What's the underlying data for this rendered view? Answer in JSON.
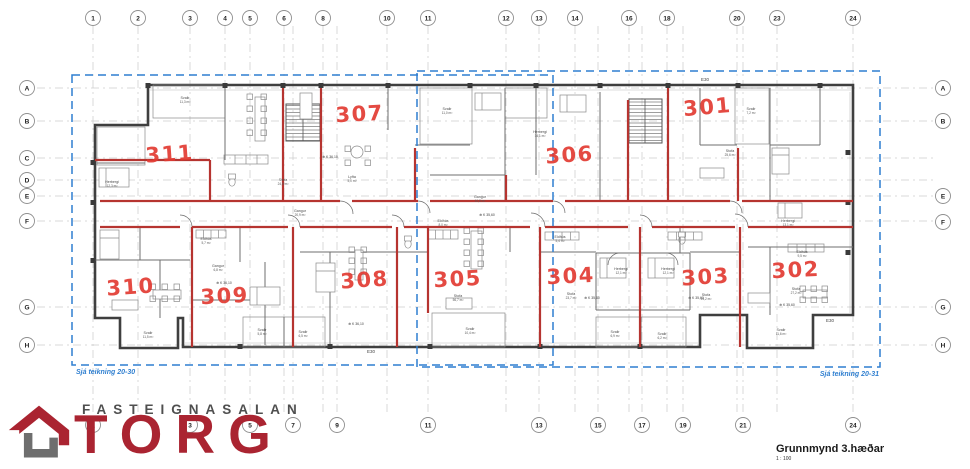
{
  "drawing": {
    "title": "Grunnmynd 3.hæðar",
    "scale": "1 : 100"
  },
  "logo": {
    "tagline": "FASTEIGNASALAN",
    "brand": "TORG"
  },
  "colors": {
    "blue_dash": "#2f7fd0",
    "red_wall": "#b63430",
    "red_number": "#e23b33",
    "wall_dark": "#3f3f3f",
    "logo_red": "#aa2431",
    "logo_gray": "#6e6e6e"
  },
  "grid": {
    "top": [
      [
        "1",
        93
      ],
      [
        "2",
        138
      ],
      [
        "3",
        190
      ],
      [
        "4",
        225
      ],
      [
        "5",
        250
      ],
      [
        "6",
        284
      ],
      [
        "8",
        323
      ],
      [
        "10",
        387
      ],
      [
        "11",
        428
      ],
      [
        "12",
        506
      ],
      [
        "13",
        539
      ],
      [
        "14",
        575
      ],
      [
        "16",
        629
      ],
      [
        "18",
        667
      ],
      [
        "20",
        737
      ],
      [
        "23",
        777
      ],
      [
        "24",
        853
      ]
    ],
    "bottom": [
      [
        "1",
        93
      ],
      [
        "3",
        190
      ],
      [
        "5",
        250
      ],
      [
        "7",
        293
      ],
      [
        "9",
        337
      ],
      [
        "11",
        428
      ],
      [
        "13",
        539
      ],
      [
        "15",
        598
      ],
      [
        "17",
        642
      ],
      [
        "19",
        683
      ],
      [
        "21",
        743
      ],
      [
        "24",
        853
      ]
    ],
    "left": [
      [
        "A",
        88
      ],
      [
        "B",
        121
      ],
      [
        "C",
        158
      ],
      [
        "D",
        180
      ],
      [
        "E",
        196
      ],
      [
        "F",
        221
      ],
      [
        "G",
        307
      ],
      [
        "H",
        345
      ]
    ],
    "right": [
      [
        "A",
        88
      ],
      [
        "B",
        121
      ],
      [
        "E",
        196
      ],
      [
        "F",
        222
      ],
      [
        "G",
        307
      ],
      [
        "H",
        345
      ]
    ]
  },
  "reference_boxes": [
    {
      "label": "Sjá teikning 20-30",
      "x": 72,
      "y": 75,
      "w": 481,
      "h": 290,
      "lx": 76,
      "ly": 374,
      "anchor": "start"
    },
    {
      "label": "Sjá teikning 20-31",
      "x": 417,
      "y": 71,
      "w": 463,
      "h": 296,
      "lx": 879,
      "ly": 376,
      "anchor": "end"
    }
  ],
  "apartments": [
    {
      "n": "311",
      "x": 170,
      "y": 161,
      "r": -4
    },
    {
      "n": "307",
      "x": 360,
      "y": 121,
      "r": -3
    },
    {
      "n": "306",
      "x": 570,
      "y": 162,
      "r": -4
    },
    {
      "n": "301",
      "x": 708,
      "y": 114,
      "r": -5
    },
    {
      "n": "310",
      "x": 131,
      "y": 294,
      "r": -4
    },
    {
      "n": "309",
      "x": 225,
      "y": 303,
      "r": -3
    },
    {
      "n": "308",
      "x": 365,
      "y": 287,
      "r": -4
    },
    {
      "n": "305",
      "x": 458,
      "y": 286,
      "r": -3
    },
    {
      "n": "304",
      "x": 571,
      "y": 283,
      "r": -3
    },
    {
      "n": "303",
      "x": 706,
      "y": 284,
      "r": -4
    },
    {
      "n": "302",
      "x": 796,
      "y": 277,
      "r": -3
    }
  ],
  "room_labels": [
    {
      "t": "Svalir",
      "a": "11,3 m²",
      "x": 185,
      "y": 99
    },
    {
      "t": "Herbergi",
      "a": "12,3 m²",
      "x": 112,
      "y": 183
    },
    {
      "t": "Stofa",
      "a": "24,8 m²",
      "x": 283,
      "y": 181
    },
    {
      "t": "Lyfta",
      "a": "5,0 m²",
      "x": 352,
      "y": 178
    },
    {
      "t": "Gangur",
      "a": "20,9 m²",
      "x": 300,
      "y": 212
    },
    {
      "t": "Svalir",
      "a": "11,0 m²",
      "x": 447,
      "y": 110
    },
    {
      "t": "Gangur",
      "a": "10,8 m²",
      "x": 480,
      "y": 198
    },
    {
      "t": "Eldhús",
      "a": "8,0 m²",
      "x": 443,
      "y": 222
    },
    {
      "t": "Svalir",
      "a": "7,2 m²",
      "x": 751,
      "y": 110
    },
    {
      "t": "Herbergi",
      "a": "14,1 m²",
      "x": 540,
      "y": 133
    },
    {
      "t": "Stofa",
      "a": "25,6 m²",
      "x": 730,
      "y": 152
    },
    {
      "t": "Gangur",
      "a": "6,8 m²",
      "x": 218,
      "y": 267
    },
    {
      "t": "Eldhús",
      "a": "5,7 m²",
      "x": 206,
      "y": 240
    },
    {
      "t": "Eldhús",
      "a": "5,4 m²",
      "x": 560,
      "y": 238
    },
    {
      "t": "Herbergi",
      "a": "12,1 m²",
      "x": 621,
      "y": 270
    },
    {
      "t": "Herbergi",
      "a": "12,1 m²",
      "x": 668,
      "y": 270
    },
    {
      "t": "Stofa",
      "a": "23,7 m²",
      "x": 571,
      "y": 295
    },
    {
      "t": "Stofa",
      "a": "24,2 m²",
      "x": 706,
      "y": 296
    },
    {
      "t": "Stofa",
      "a": "27,2 m²",
      "x": 796,
      "y": 290
    },
    {
      "t": "Herbergi",
      "a": "13,1 m²",
      "x": 788,
      "y": 222
    },
    {
      "t": "Eldhús",
      "a": "9,5 m²",
      "x": 802,
      "y": 253
    },
    {
      "t": "Stofa",
      "a": "56,7 m²",
      "x": 458,
      "y": 297
    },
    {
      "t": "Svalir",
      "a": "11,5 m²",
      "x": 148,
      "y": 334
    },
    {
      "t": "Svalir",
      "a": "5,8 m²",
      "x": 262,
      "y": 331
    },
    {
      "t": "Svalir",
      "a": "6,5 m²",
      "x": 303,
      "y": 333
    },
    {
      "t": "Svalir",
      "a": "10,4 m²",
      "x": 470,
      "y": 330
    },
    {
      "t": "Svalir",
      "a": "6,9 m²",
      "x": 615,
      "y": 333
    },
    {
      "t": "Svalir",
      "a": "6,2 m²",
      "x": 662,
      "y": 335
    },
    {
      "t": "Svalir",
      "a": "11,6 m²",
      "x": 781,
      "y": 331
    }
  ],
  "elevation_marks": [
    {
      "t": "K 36,10",
      "x": 330,
      "y": 158
    },
    {
      "t": "K 35,60",
      "x": 487,
      "y": 216
    },
    {
      "t": "K 36,10",
      "x": 224,
      "y": 284
    },
    {
      "t": "K 36,10",
      "x": 356,
      "y": 325
    },
    {
      "t": "K 35,60",
      "x": 592,
      "y": 299
    },
    {
      "t": "K 35,60",
      "x": 696,
      "y": 299
    },
    {
      "t": "K 35,60",
      "x": 787,
      "y": 306
    }
  ],
  "edge_labels": [
    {
      "t": "E30",
      "x": 705,
      "y": 81
    },
    {
      "t": "E30",
      "x": 371,
      "y": 353
    },
    {
      "t": "E30",
      "x": 830,
      "y": 322
    }
  ]
}
